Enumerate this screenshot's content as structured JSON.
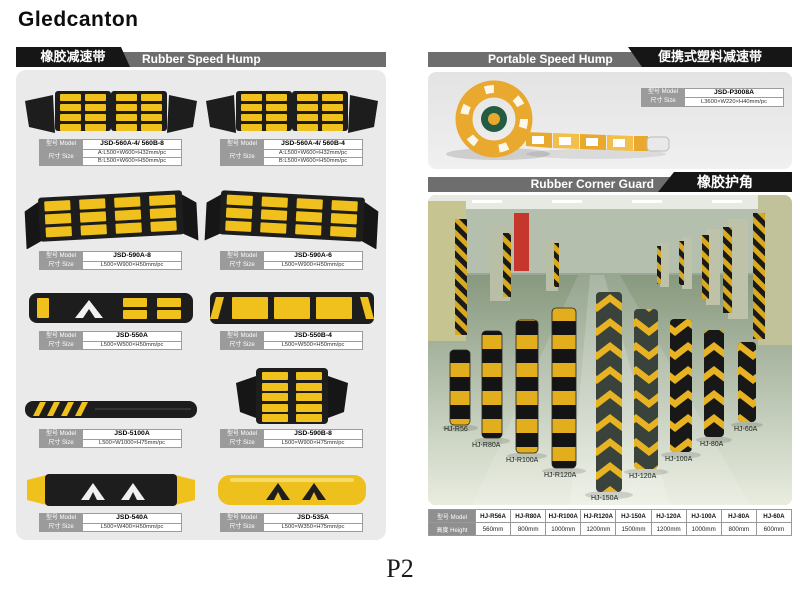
{
  "page": {
    "brand": "Gledcanton",
    "page_number": "P2"
  },
  "labels": {
    "model": "型号 Model",
    "size": "尺寸 Size",
    "height": "高度 Height"
  },
  "rubber_speed_hump": {
    "title_cn": "橡胶减速带",
    "title_en": "Rubber Speed Hump",
    "products": [
      {
        "model": "JSD-560A-4/ 560B-8",
        "size_a": "A:L500×W600×H32mm/pc",
        "size_b": "B:L500×W600×H50mm/pc"
      },
      {
        "model": "JSD-560A-4/ 560B-4",
        "size_a": "A:L500×W600×H32mm/pc",
        "size_b": "B:L500×W600×H50mm/pc"
      },
      {
        "model": "JSD-590A-8",
        "size": "L500×W900×H50mm/pc"
      },
      {
        "model": "JSD-590A-6",
        "size": "L500×W900×H50mm/pc"
      },
      {
        "model": "JSD-550A",
        "size": "L500×W500×H50mm/pc"
      },
      {
        "model": "JSD-550B-4",
        "size": "L500×W500×H50mm/pc"
      },
      {
        "model": "JSD-5100A",
        "size": "L500×W1000×H75mm/pc"
      },
      {
        "model": "JSD-590B-8",
        "size": "L500×W900×H75mm/pc"
      },
      {
        "model": "JSD-540A",
        "size": "L500×W400×H50mm/pc"
      },
      {
        "model": "JSD-535A",
        "size": "L500×W350×H75mm/pc"
      }
    ]
  },
  "portable_speed_hump": {
    "title_en": "Portable Speed Hump",
    "title_cn": "便携式塑料减速带",
    "model": "JSD-P3008A",
    "size": "L3600×W220×H40mm/pc"
  },
  "rubber_corner_guard": {
    "title_en": "Rubber Corner Guard",
    "title_cn": "橡胶护角",
    "photo_labels": [
      "HJ-R56",
      "HJ-R80A",
      "HJ-R100A",
      "HJ-R120A",
      "HJ-150A",
      "HJ-120A",
      "HJ-100A",
      "HJ-80A",
      "HJ-60A"
    ],
    "table": {
      "models": [
        "HJ-R56A",
        "HJ-R80A",
        "HJ-R100A",
        "HJ-R120A",
        "HJ-150A",
        "HJ-120A",
        "HJ-100A",
        "HJ-80A",
        "HJ-60A"
      ],
      "heights": [
        "560mm",
        "800mm",
        "1000mm",
        "1200mm",
        "1500mm",
        "1200mm",
        "1000mm",
        "800mm",
        "600mm"
      ]
    }
  },
  "colors": {
    "accent_yellow": "#f0c11c",
    "rubber_black": "#1d1d1d",
    "header_gray": "#6e6e6e"
  }
}
